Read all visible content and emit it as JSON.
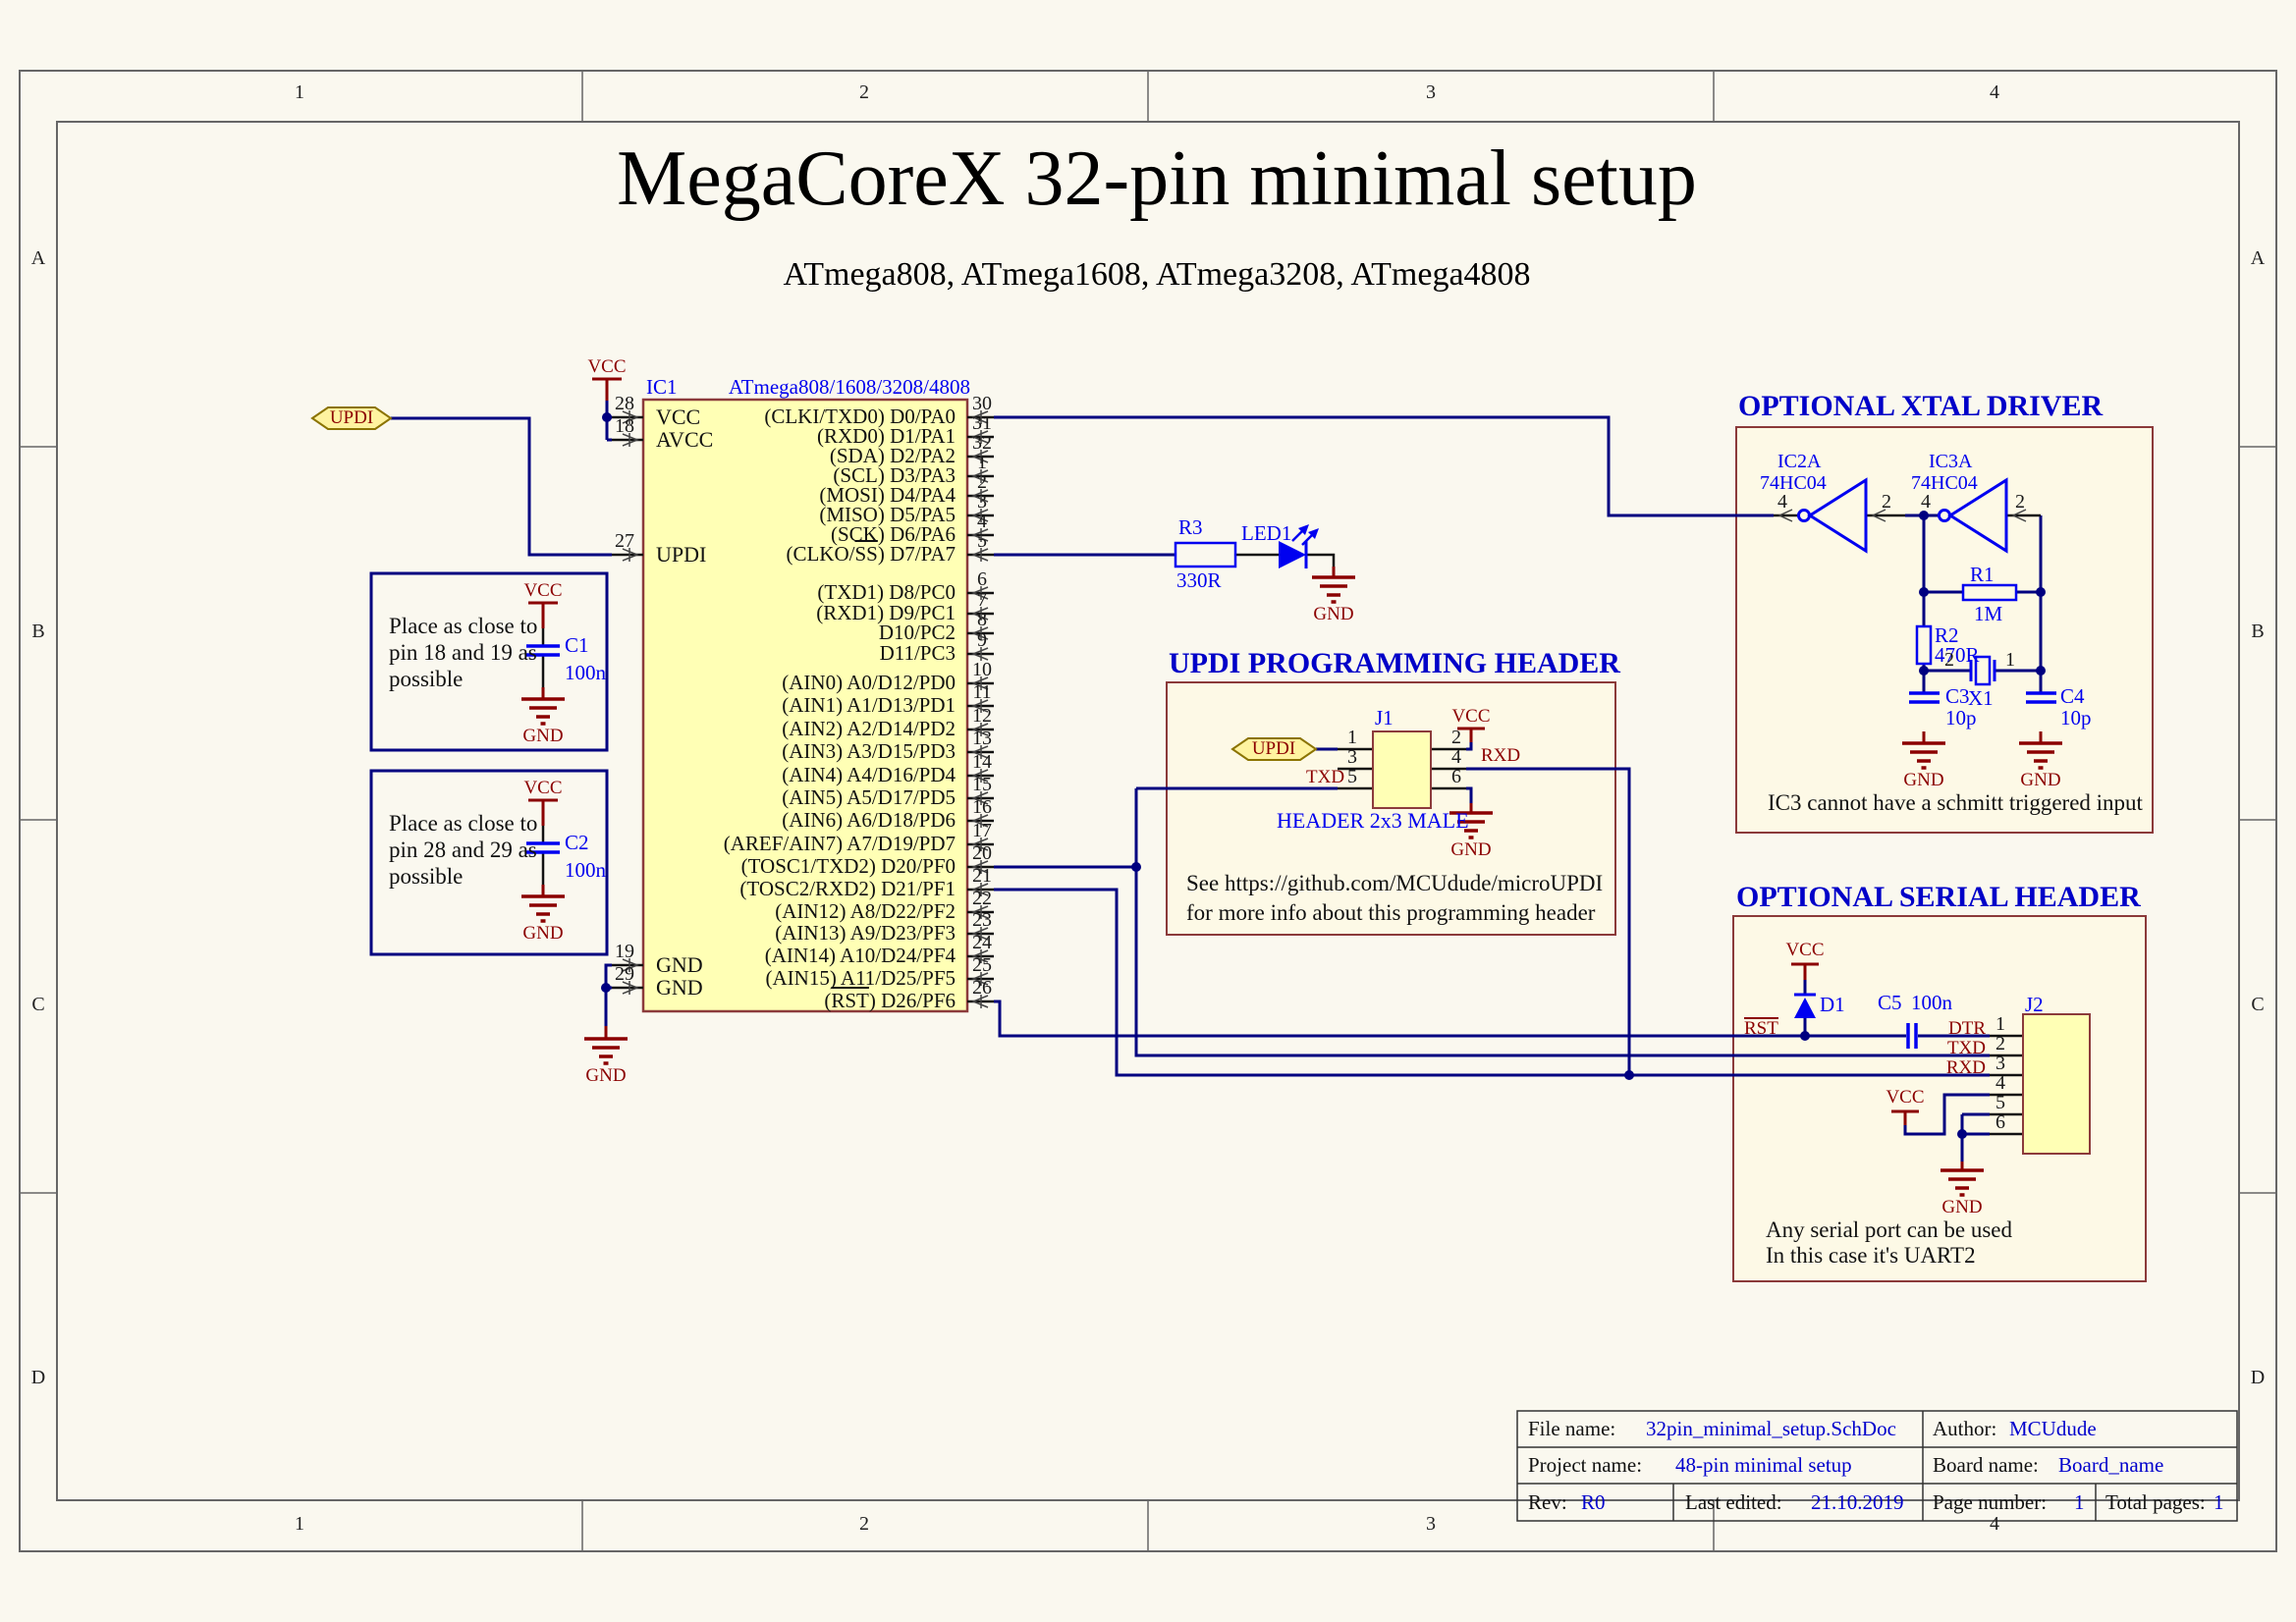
{
  "sheet": {
    "title": "MegaCoreX 32-pin minimal setup",
    "subtitle": "ATmega808, ATmega1608, ATmega3208, ATmega4808",
    "border": {
      "columns": [
        "1",
        "2",
        "3",
        "4"
      ],
      "rows": [
        "A",
        "B",
        "C",
        "D"
      ]
    }
  },
  "colors": {
    "wire": "#000080",
    "component_blue": "#0000EE",
    "power_red": "#8B0000",
    "ic_fill": "#FFFFB5",
    "ic_border": "#8C3B3B",
    "section_box_fill": "#FDF9E6",
    "section_box_border": "#8B3A3A",
    "note_box_border": "#000080",
    "port_fill": "#FFF3A0",
    "port_border": "#8B7300",
    "sheet_bg": "#FAF8EF",
    "section_title": "#0000C8"
  },
  "power": {
    "vcc": "VCC",
    "gnd": "GND"
  },
  "updi_port": {
    "label": "UPDI"
  },
  "ic1": {
    "designator": "IC1",
    "part": "ATmega808/1608/3208/4808",
    "left_pins": [
      {
        "number": "28",
        "name": "VCC"
      },
      {
        "number": "18",
        "name": "AVCC"
      },
      {
        "number": "27",
        "name": "UPDI"
      },
      {
        "number": "19",
        "name": "GND"
      },
      {
        "number": "29",
        "name": "GND"
      }
    ],
    "right_pin_groups": [
      {
        "pins": [
          {
            "number": "30",
            "label": "(CLKI/TXD0) D0/PA0"
          },
          {
            "number": "31",
            "label": "(RXD0) D1/PA1"
          },
          {
            "number": "32",
            "label": "(SDA) D2/PA2"
          },
          {
            "number": "1",
            "label": "(SCL) D3/PA3"
          },
          {
            "number": "2",
            "label": "(MOSI) D4/PA4"
          },
          {
            "number": "3",
            "label": "(MISO) D5/PA5"
          },
          {
            "number": "4",
            "label": "(SCK) D6/PA6"
          },
          {
            "number": "5",
            "label": "(CLKO/SS) D7/PA7",
            "overline": "SS"
          }
        ]
      },
      {
        "pins": [
          {
            "number": "6",
            "label": "(TXD1) D8/PC0"
          },
          {
            "number": "7",
            "label": "(RXD1) D9/PC1"
          },
          {
            "number": "8",
            "label": "D10/PC2"
          },
          {
            "number": "9",
            "label": "D11/PC3"
          }
        ]
      },
      {
        "pins": [
          {
            "number": "10",
            "label": "(AIN0) A0/D12/PD0"
          },
          {
            "number": "11",
            "label": "(AIN1) A1/D13/PD1"
          },
          {
            "number": "12",
            "label": "(AIN2) A2/D14/PD2"
          },
          {
            "number": "13",
            "label": "(AIN3) A3/D15/PD3"
          },
          {
            "number": "14",
            "label": "(AIN4) A4/D16/PD4"
          },
          {
            "number": "15",
            "label": "(AIN5) A5/D17/PD5"
          },
          {
            "number": "16",
            "label": "(AIN6) A6/D18/PD6"
          },
          {
            "number": "17",
            "label": "(AREF/AIN7) A7/D19/PD7"
          }
        ]
      },
      {
        "pins": [
          {
            "number": "20",
            "label": "(TOSC1/TXD2) D20/PF0"
          },
          {
            "number": "21",
            "label": "(TOSC2/RXD2) D21/PF1"
          },
          {
            "number": "22",
            "label": "(AIN12) A8/D22/PF2"
          },
          {
            "number": "23",
            "label": "(AIN13) A9/D23/PF3"
          },
          {
            "number": "24",
            "label": "(AIN14) A10/D24/PF4"
          },
          {
            "number": "25",
            "label": "(AIN15) A11/D25/PF5"
          },
          {
            "number": "26",
            "label": "(RST) D26/PF6",
            "overline": "RST"
          }
        ]
      }
    ]
  },
  "decoupling_notes": [
    {
      "lines": [
        "Place as close to",
        "pin 18 and 19 as",
        "possible"
      ],
      "cap_designator": "C1",
      "cap_value": "100n"
    },
    {
      "lines": [
        "Place as close to",
        "pin 28 and 29 as",
        "possible"
      ],
      "cap_designator": "C2",
      "cap_value": "100n"
    }
  ],
  "led_circuit": {
    "resistor": "R3",
    "resistor_value": "330R",
    "led": "LED1"
  },
  "updi_header": {
    "title": "UPDI PROGRAMMING HEADER",
    "designator": "J1",
    "port_label": "UPDI",
    "type_label": "HEADER 2x3 MALE",
    "pins_left": [
      "1",
      "3",
      "5"
    ],
    "pins_right": [
      "2",
      "4",
      "6"
    ],
    "txd": "TXD",
    "rxd": "RXD",
    "note1": "See https://github.com/MCUdude/microUPDI",
    "note2": "for more info about this programming header"
  },
  "xtal_driver": {
    "title": "OPTIONAL XTAL DRIVER",
    "gates": [
      {
        "designator": "IC2A",
        "part": "74HC04",
        "output_pin": "4",
        "input_pin": "2"
      },
      {
        "designator": "IC3A",
        "part": "74HC04",
        "output_pin": "4",
        "input_pin": "2"
      }
    ],
    "r1": {
      "designator": "R1",
      "value": "1M"
    },
    "r2": {
      "designator": "R2",
      "value": "470R"
    },
    "crystal": {
      "designator": "X1",
      "pin_left": "2",
      "pin_right": "1"
    },
    "c3": {
      "designator": "C3",
      "value": "10p"
    },
    "c4": {
      "designator": "C4",
      "value": "10p"
    },
    "note": "IC3 cannot have a schmitt triggered input"
  },
  "serial_header": {
    "title": "OPTIONAL SERIAL HEADER",
    "designator": "J2",
    "diode": "D1",
    "cap": {
      "designator": "C5",
      "value": "100n"
    },
    "rst": "RST",
    "dtr": "DTR",
    "txd": "TXD",
    "rxd": "RXD",
    "pin_numbers": [
      "1",
      "2",
      "3",
      "4",
      "5",
      "6"
    ],
    "note1": "Any serial port can be used",
    "note2": "In this case it's UART2"
  },
  "title_block": {
    "file_name_label": "File name:",
    "file_name": "32pin_minimal_setup.SchDoc",
    "author_label": "Author:",
    "author": "MCUdude",
    "project_name_label": "Project name:",
    "project_name": "48-pin minimal setup",
    "board_name_label": "Board name:",
    "board_name": "Board_name",
    "rev_label": "Rev:",
    "rev": "R0",
    "last_edited_label": "Last edited:",
    "last_edited": "21.10.2019",
    "page_number_label": "Page number:",
    "page_number": "1",
    "total_pages_label": "Total pages:",
    "total_pages": "1"
  }
}
